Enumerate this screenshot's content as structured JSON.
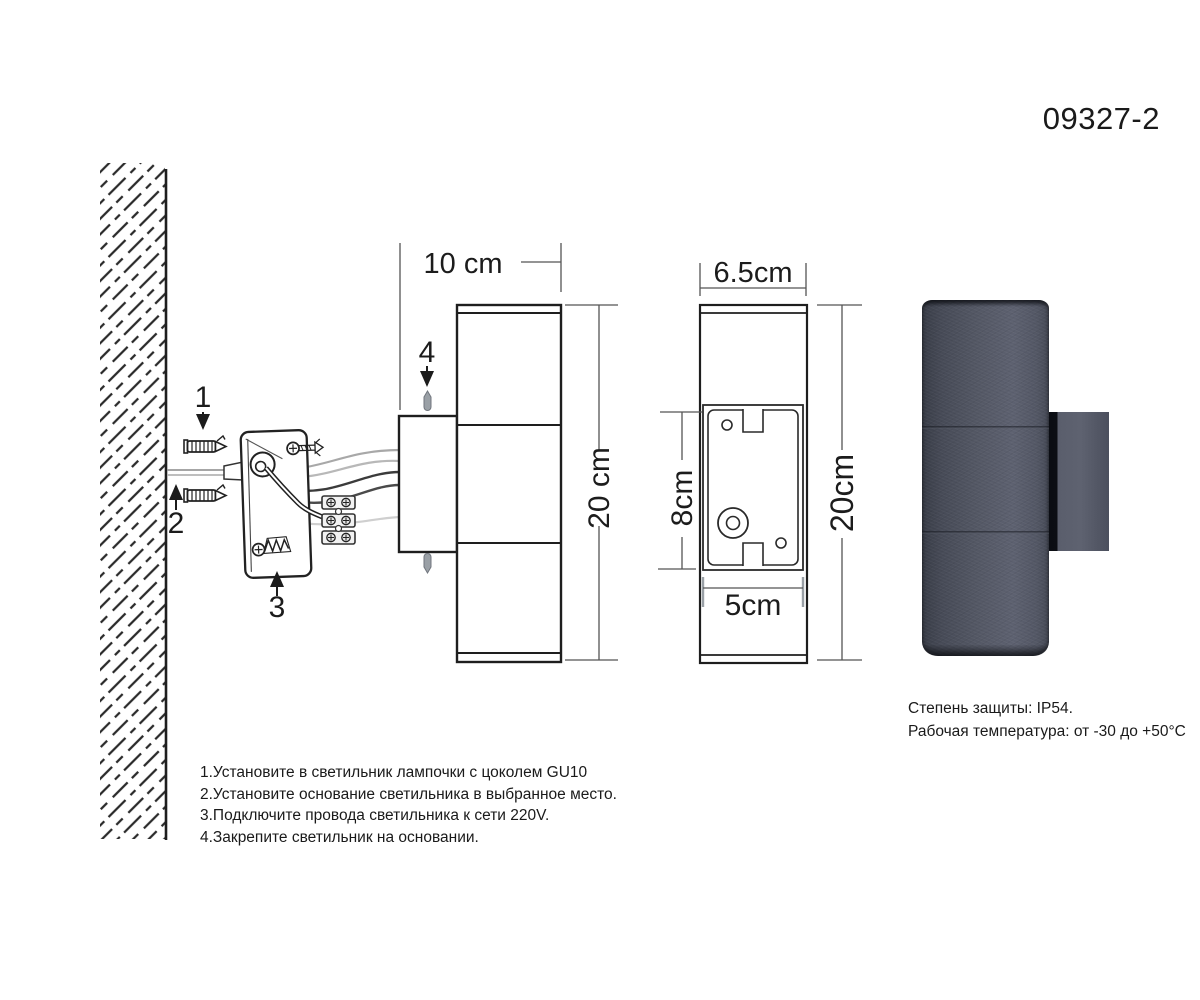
{
  "page": {
    "model_number": "09327-2"
  },
  "callouts": {
    "step1": "1",
    "step2": "2",
    "step3": "3",
    "step4": "4"
  },
  "side_view": {
    "depth_label": "10 cm",
    "height_label": "20 cm"
  },
  "front_view": {
    "width_label": "6.5cm",
    "plate_height_label": "8cm",
    "plate_width_label": "5cm",
    "height_label": "20cm"
  },
  "specs": {
    "protection": "Степень защиты: IP54.",
    "temperature": "Рабочая температура: от -30 до +50°C"
  },
  "instructions": [
    "1.Установите в светильник лампочки с цоколем GU10",
    "2.Установите основание светильника в выбранное место.",
    "3.Подключите провода светильника к сети 220V.",
    "4.Закрепите светильник на основании."
  ],
  "colors": {
    "line": "#222222",
    "dim": "#555555",
    "gray": "#9aa0a6",
    "lamp_body": "#4e5260",
    "lamp_bracket": "#565a68"
  }
}
